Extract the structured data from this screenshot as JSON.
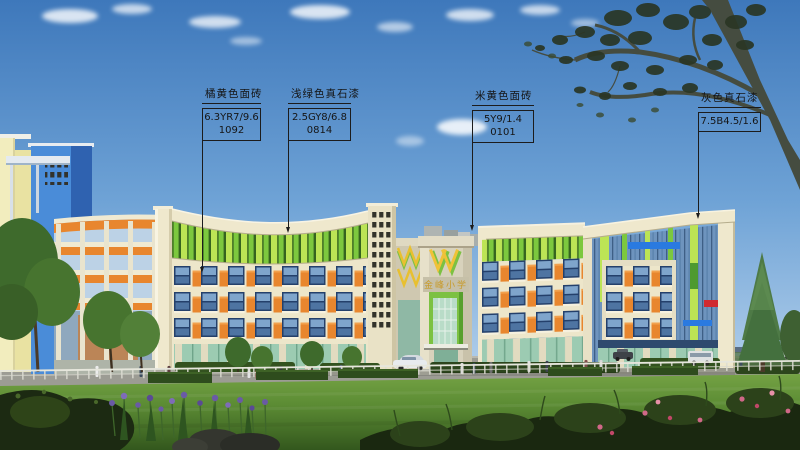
{
  "scene": {
    "description": "architectural elevation rendering of a primary school",
    "school_sign": "金峰小学"
  },
  "annotations": [
    {
      "title": "橘黄色面砖",
      "code_line1": "6.3YR7/9.6",
      "code_line2": "1092"
    },
    {
      "title": "浅绿色真石漆",
      "code_line1": "2.5GY8/6.8",
      "code_line2": "0814"
    },
    {
      "title": "米黄色面砖",
      "code_line1": "5Y9/1.4",
      "code_line2": "0101"
    },
    {
      "title": "灰色真石漆",
      "code_line1": "7.5B4.5/1.6"
    }
  ],
  "colors": {
    "sky_top": "#3E78BB",
    "sky_horizon": "#D6E7F4",
    "facade_beige": "#EDE6CA",
    "louver_green_light": "#BCE455",
    "louver_green_mid": "#7CC83E",
    "panel_orange": "#E8862E",
    "tower_blue": "#4A8CD8",
    "entrance_green": "#7CC142",
    "accent_blue": "#2A7AE0",
    "accent_red": "#D02A30",
    "lawn_green": "#5C8C34",
    "annotation_line": "#1C1C1C"
  }
}
